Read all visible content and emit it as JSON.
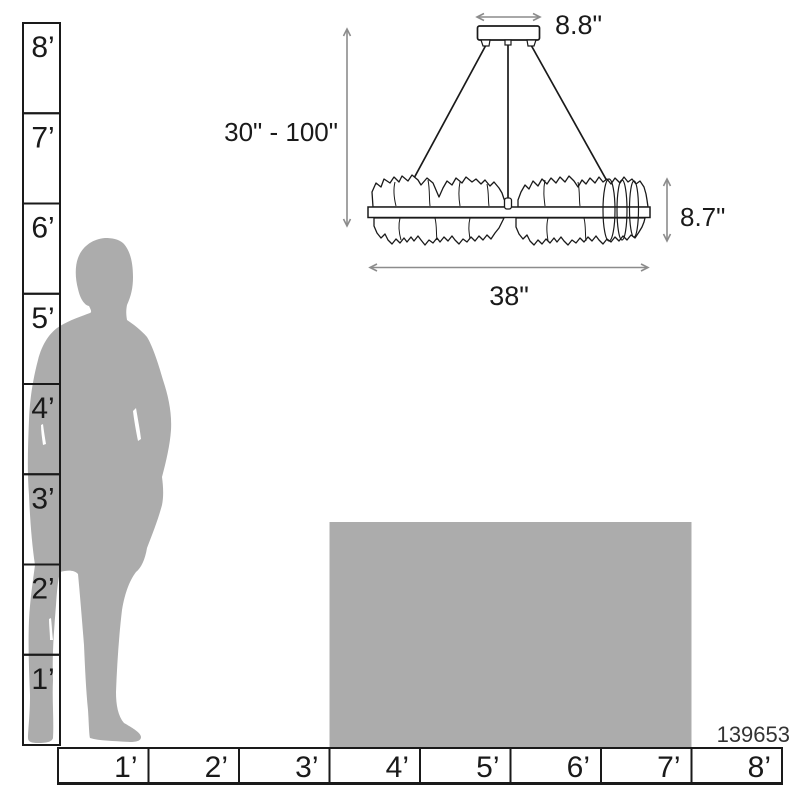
{
  "product": {
    "code": "139653"
  },
  "colors": {
    "background": "#FFFFFF",
    "silhouette_gray": "#ACACAC",
    "furniture_gray": "#ACACAC",
    "outline_black": "#1A1A1A",
    "dimension_gray": "#8C8C8C"
  },
  "vertical_ruler": {
    "unit": "feet",
    "labels": [
      "8’",
      "7’",
      "6’",
      "5’",
      "4’",
      "3’",
      "2’",
      "1’"
    ]
  },
  "horizontal_ruler": {
    "unit": "feet",
    "labels": [
      "1’",
      "2’",
      "3’",
      "4’",
      "5’",
      "6’",
      "7’",
      "8’"
    ]
  },
  "fixture_dimensions": {
    "canopy_width": "8.8\"",
    "suspension_range": "30\" - 100\"",
    "body_height": "8.7\"",
    "body_width": "38\""
  }
}
